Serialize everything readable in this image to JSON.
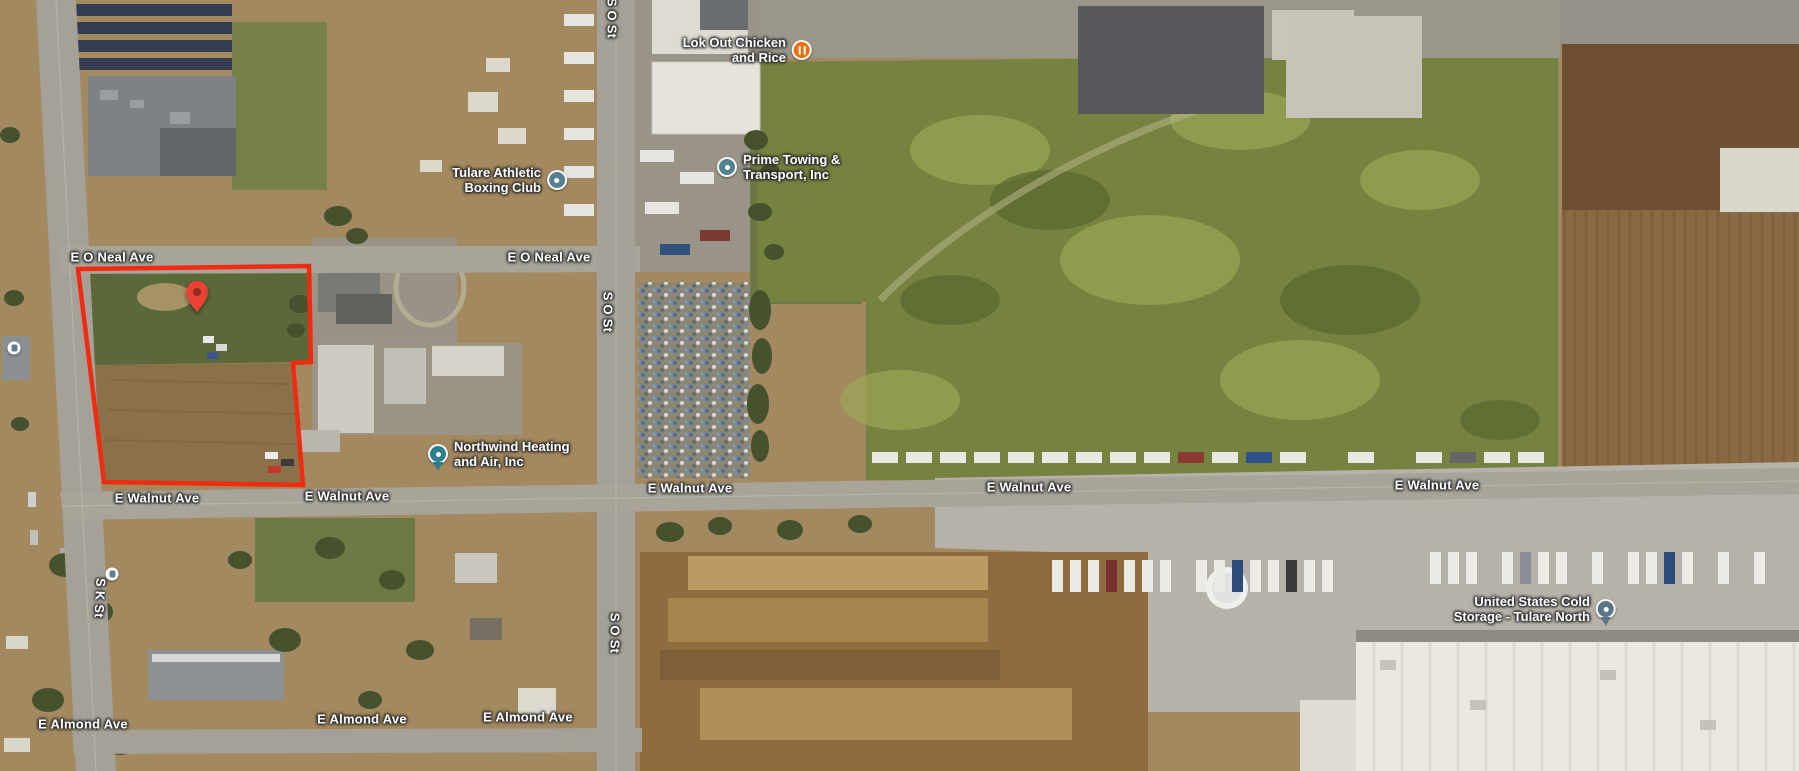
{
  "road_labels": [
    {
      "text": "E O Neal Ave",
      "x": 112,
      "y": 257
    },
    {
      "text": "E O Neal Ave",
      "x": 549,
      "y": 257
    },
    {
      "text": "E Walnut Ave",
      "x": 157,
      "y": 498
    },
    {
      "text": "E Walnut Ave",
      "x": 347,
      "y": 496
    },
    {
      "text": "E Walnut Ave",
      "x": 690,
      "y": 488
    },
    {
      "text": "E Walnut Ave",
      "x": 1029,
      "y": 487
    },
    {
      "text": "E Walnut Ave",
      "x": 1437,
      "y": 485
    },
    {
      "text": "E Almond Ave",
      "x": 83,
      "y": 724
    },
    {
      "text": "E Almond Ave",
      "x": 362,
      "y": 719
    },
    {
      "text": "E Almond Ave",
      "x": 528,
      "y": 717
    },
    {
      "text": "S O St",
      "x": 612,
      "y": 18,
      "rot": 90
    },
    {
      "text": "S O St",
      "x": 608,
      "y": 312,
      "rot": 90
    },
    {
      "text": "S O St",
      "x": 615,
      "y": 633,
      "rot": 90
    },
    {
      "text": "S K St",
      "x": 100,
      "y": 598,
      "rot": 93
    }
  ],
  "places": [
    {
      "name": "Lok Out Chicken and Rice",
      "lines": [
        "Lok Out Chicken",
        "and Rice"
      ],
      "icon": "restaurant",
      "color": "#e8710a",
      "x": 802,
      "y": 50
    },
    {
      "name": "Tulare Athletic Boxing Club",
      "lines": [
        "Tulare Athletic",
        "Boxing Club"
      ],
      "icon": "poi",
      "color": "#55808f",
      "x": 557,
      "y": 180
    },
    {
      "name": "Prime Towing & Transport, Inc",
      "lines": [
        "Prime Towing &",
        "Transport, Inc"
      ],
      "icon": "poi",
      "color": "#55808f",
      "x": 727,
      "y": 167
    },
    {
      "name": "Northwind Heating and Air, Inc",
      "lines": [
        "Northwind Heating",
        "and Air, Inc"
      ],
      "icon": "pin",
      "color": "#2e7f8e",
      "x": 438,
      "y": 454
    },
    {
      "name": "United States Cold Storage - Tulare North",
      "lines": [
        "United States Cold",
        "Storage - Tulare North"
      ],
      "icon": "pin",
      "color": "#5b7486",
      "x": 1606,
      "y": 609
    }
  ],
  "transit_stops": [
    {
      "x": 14,
      "y": 348
    },
    {
      "x": 112,
      "y": 574
    }
  ],
  "parcel": {
    "outline_color": "#f22b10",
    "points": "78,269 309,266 311,362 293,363 303,485 104,482",
    "pin": {
      "x": 197,
      "y": 312,
      "color": "#ea4335",
      "inner_color": "#8f2c21"
    }
  }
}
